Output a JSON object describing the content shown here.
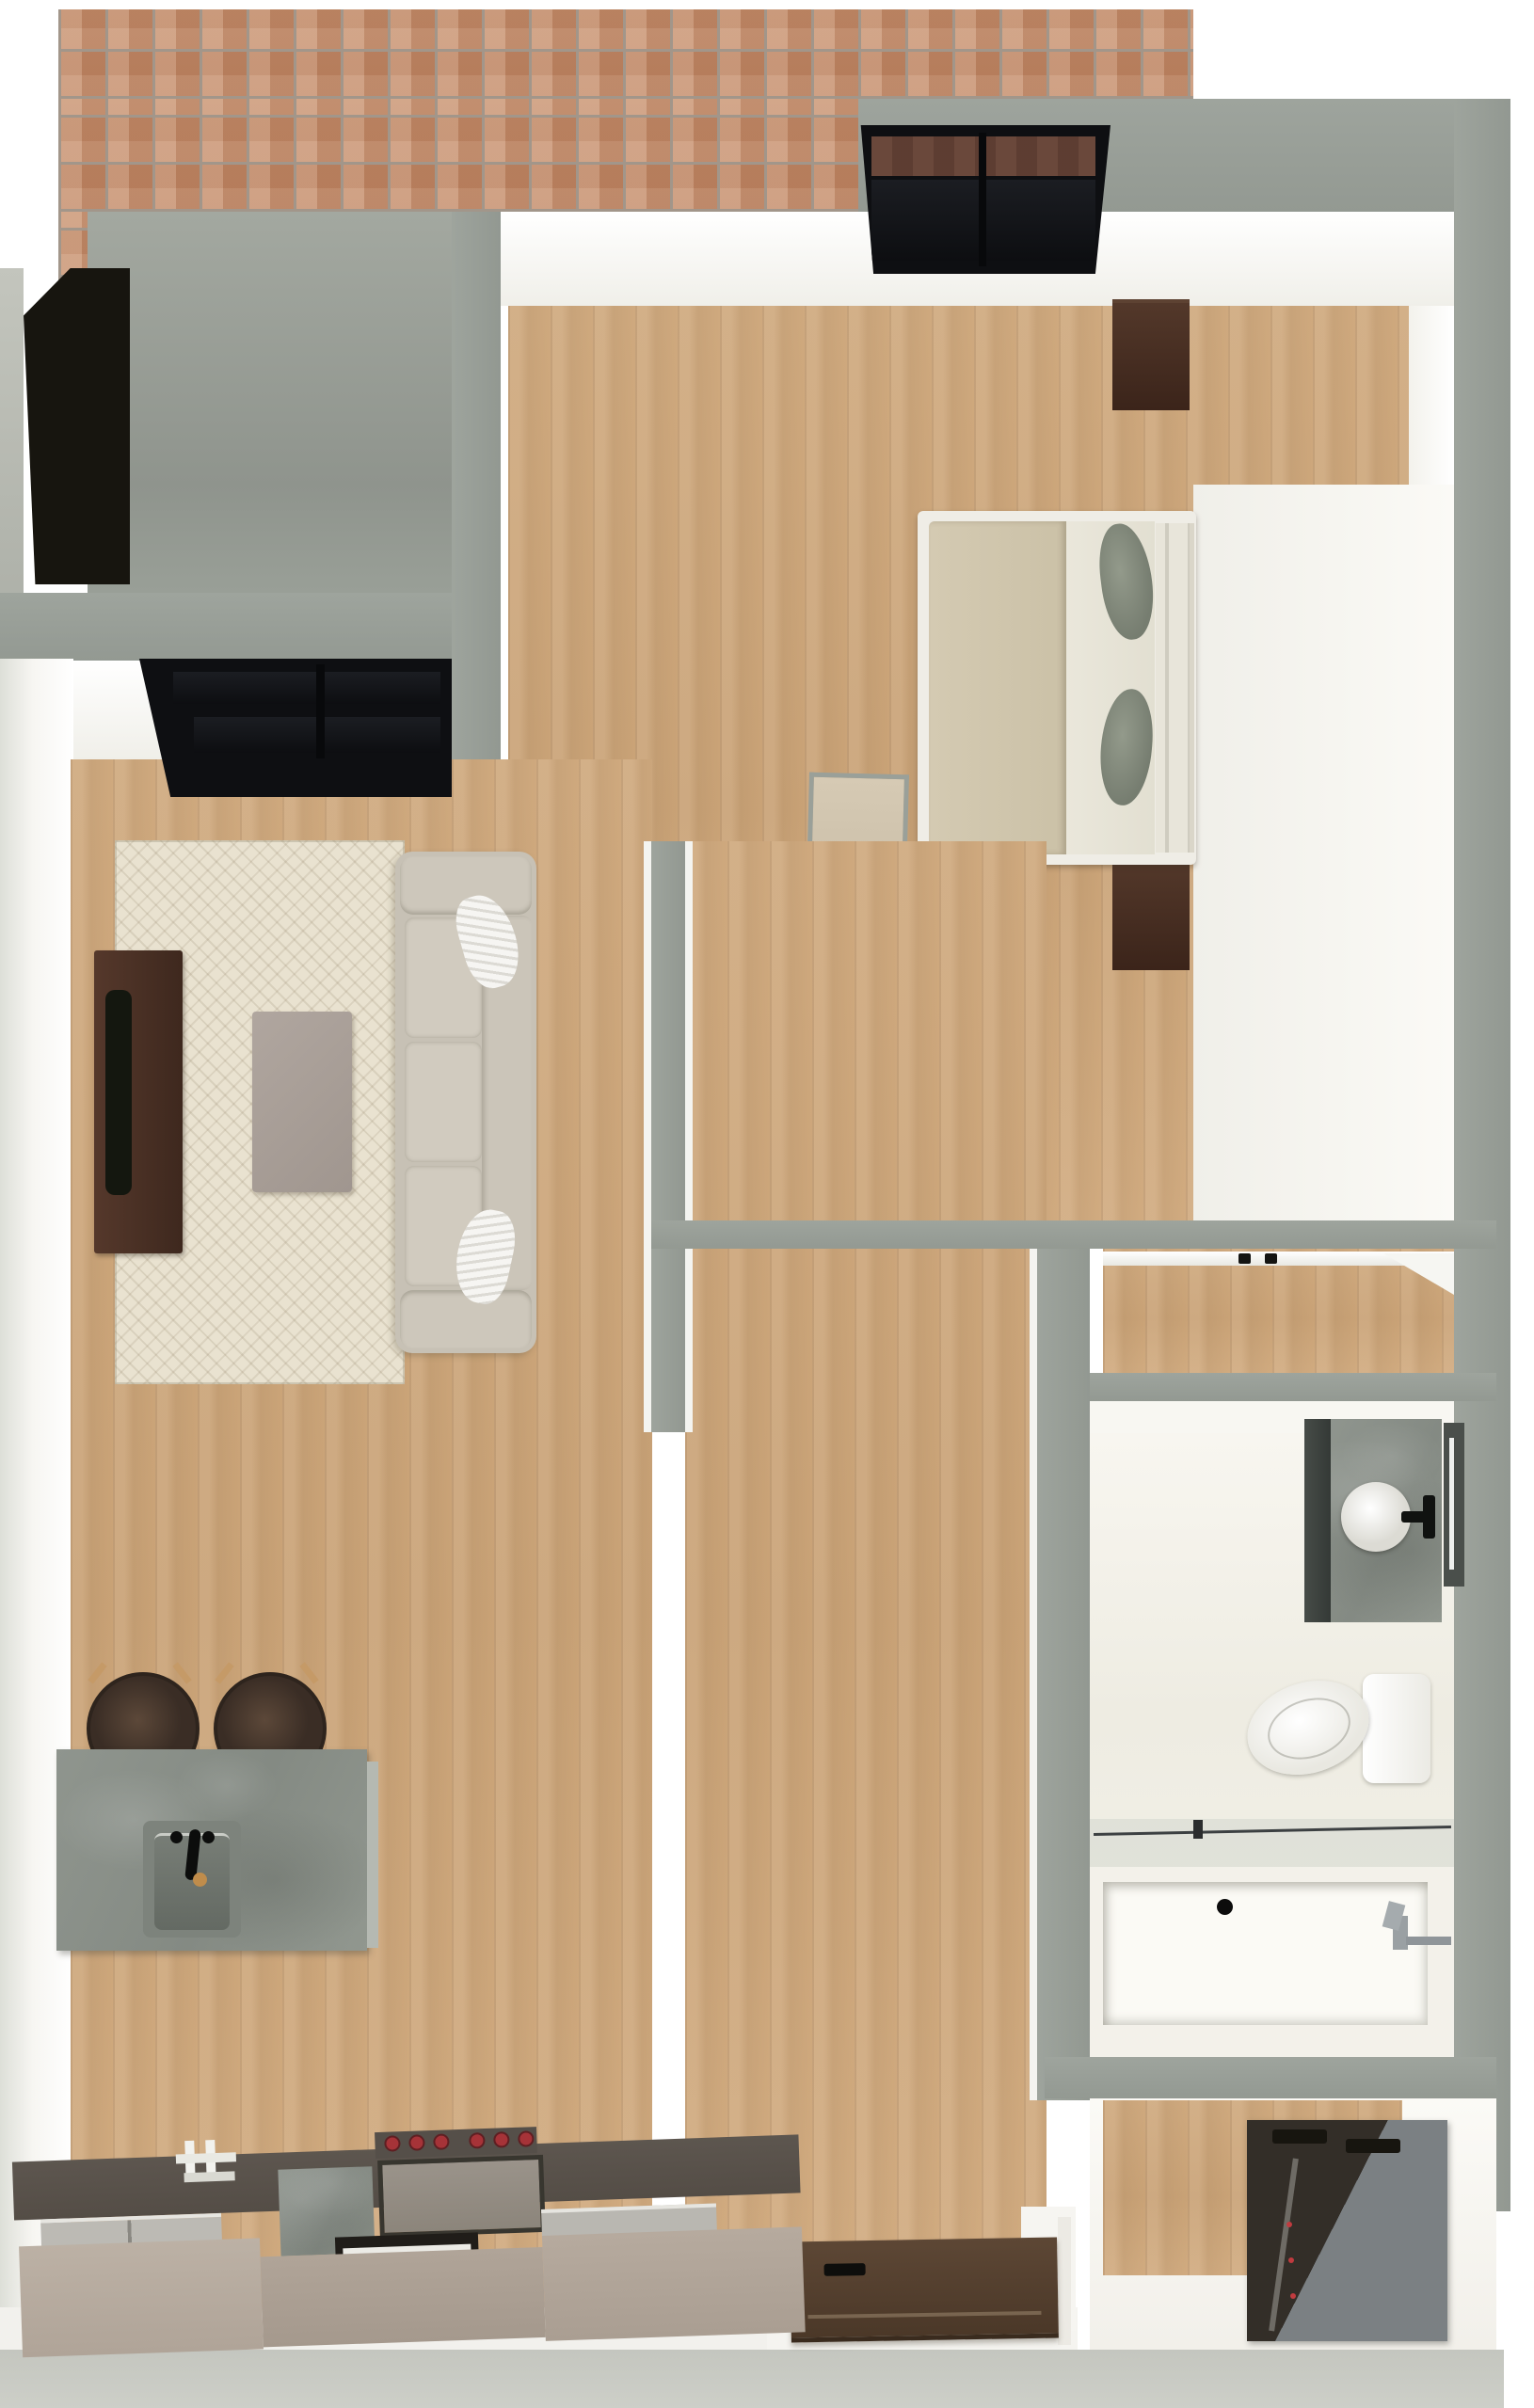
{
  "meta": {
    "title": "One-bedroom apartment — top-down 3D rendered floor plan",
    "view": "dollhouse top view",
    "visible_text_in_image": "none"
  },
  "palette": {
    "wall_gray": "#99A099",
    "brick": "#C38B68",
    "brick_grout": "#A2968A",
    "concrete_pad": "#9BA098",
    "wood_floor": "#CDA87E",
    "rug": "#E9E2D0",
    "sofa": "#C7C1B5",
    "throw_pillow": "#F4F3F0",
    "coffee_table": "#A89E97",
    "tv_console": "#4A3128",
    "tv": "#14170F",
    "island_concrete": "#8E948D",
    "sink_basin": "#6E746D",
    "faucet_black": "#101210",
    "drain_brass": "#BF8C4B",
    "bar_stool": "#44362D",
    "bed_frame": "#EFEDE6",
    "duvet_tan": "#CFC5AC",
    "sheet": "#EAE7DB",
    "bed_pillow_sage": "#878D7F",
    "nightstand": "#44291E",
    "window_frame": "#0E0F12",
    "entry_door": "#55412F",
    "bedroom_door": "#CFC3AE",
    "bath_floor": "#F2F0E8",
    "vanity_counter": "#8B928B",
    "vanity_front": "#3C413D",
    "toilet": "#FBFBF9",
    "bathtub": "#F3F1EA",
    "chrome": "#9AA0A3",
    "washer_top": "#332E28",
    "washer_side": "#7B8083",
    "range_knob_red": "#A63338",
    "counter_base": "#B7AB9F",
    "counter_top": "#59524B",
    "bottom_band": "#C9CBC4"
  },
  "rooms": {
    "patio": {
      "label": "patio",
      "features": [
        "brick pavers",
        "concrete pad",
        "dark step / planter"
      ]
    },
    "living_room": {
      "label": "living room",
      "furniture": [
        "sofa with two white throw pillows",
        "patterned area rug",
        "coffee table",
        "dark wood TV console",
        "flat-screen TV",
        "black-framed window"
      ]
    },
    "kitchen": {
      "label": "kitchen",
      "furniture": [
        "concrete island with undermount sink and black faucet",
        "two round bar stools",
        "counter run with white faucet sink",
        "dishwasher panels",
        "range with six red knobs",
        "oven with window",
        "concrete end block"
      ]
    },
    "bedroom": {
      "label": "bedroom",
      "furniture": [
        "bed with tan duvet, white sheet and two sage pillows",
        "two dark wood nightstands",
        "black-framed window",
        "open beige door leaf"
      ]
    },
    "bathroom": {
      "label": "bathroom",
      "furniture": [
        "vanity with concrete top and round vessel sink",
        "black faucet",
        "wall mirror with light strip",
        "toilet",
        "bathtub with glass screen",
        "chrome shower fixture"
      ]
    },
    "closet": {
      "label": "hall closet",
      "furniture": [
        "closet rod with two hangers"
      ]
    },
    "laundry": {
      "label": "laundry closet",
      "furniture": [
        "stacked washer-dryer unit"
      ]
    },
    "entry": {
      "label": "entry",
      "furniture": [
        "open dark-brown entry door with black handle"
      ]
    }
  }
}
